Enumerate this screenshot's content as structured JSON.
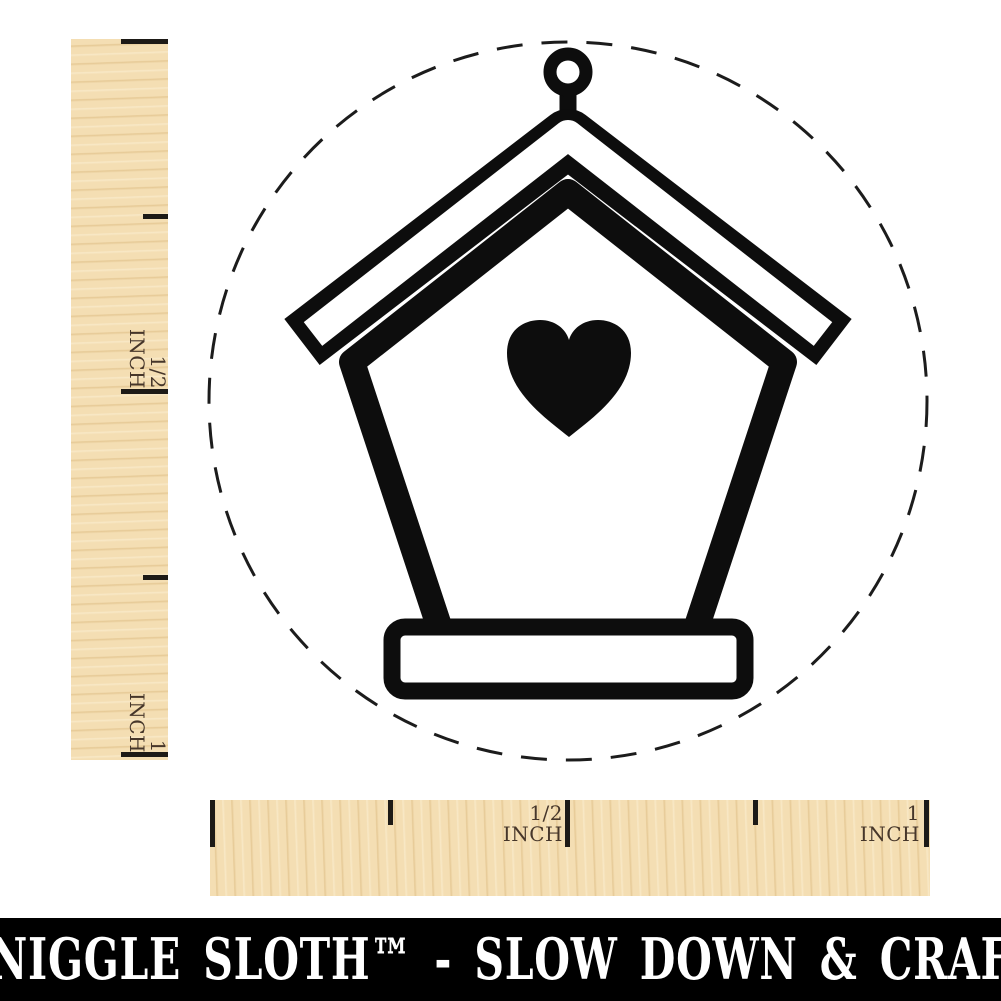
{
  "colors": {
    "ink": "#0d0d0d",
    "paper": "#ffffff",
    "dash_circle": "#1c1c1c",
    "wood": "#f4deb3",
    "tick": "#1d1a16",
    "ruler_label": "#46362a",
    "footer_bg": "#000000",
    "footer_text": "#ffffff"
  },
  "stamp": {
    "design_name": "birdhouse with heart opening, hanging ring on roof",
    "boundary": "dashed circle stamp impression outline"
  },
  "rulers": {
    "vertical": {
      "half_inch_label": "1/2\nINCH",
      "one_inch_label": "1\nINCH"
    },
    "horizontal": {
      "half_inch_label": "1/2\nINCH",
      "one_inch_label": "1\nINCH"
    }
  },
  "footer": {
    "brand_tagline": "SNIGGLE SLOTH™ - SLOW DOWN & CRAFT"
  }
}
